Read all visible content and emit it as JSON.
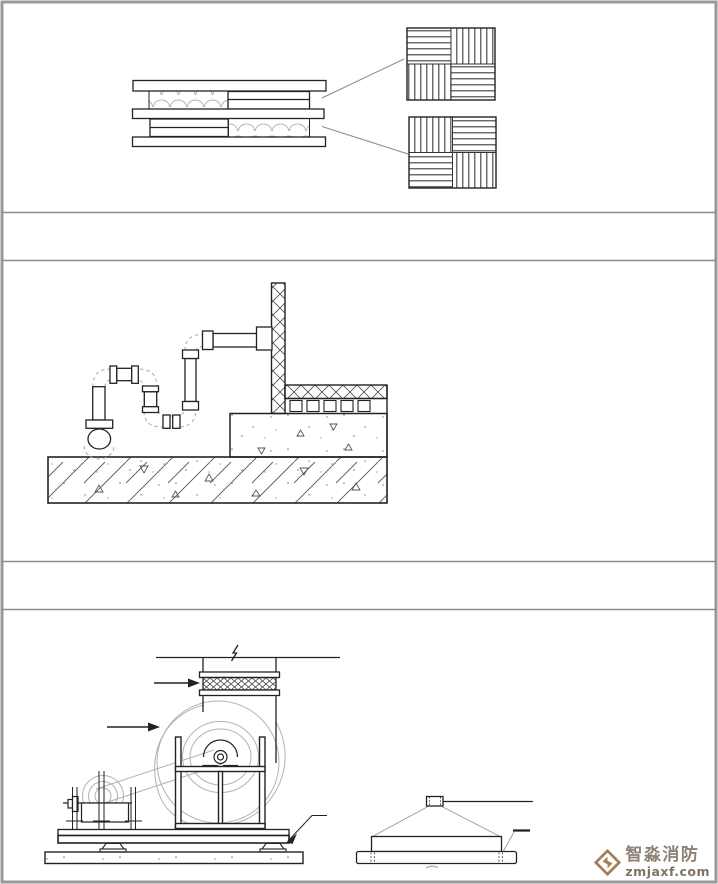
{
  "watermark": {
    "brand": "智淼消防",
    "domain": "zmjaxf.com",
    "logo_icon": "diamond-z-logo-icon",
    "text_color": "#8d8174",
    "logo_color": "#a57e58"
  },
  "colors": {
    "background": "#ffffff",
    "main_line": "#222222",
    "light_line": "#b2b2b2",
    "hatch_line": "#3a3a3a",
    "divider_line": "#8c8c8c",
    "outer_border": "#989898"
  }
}
